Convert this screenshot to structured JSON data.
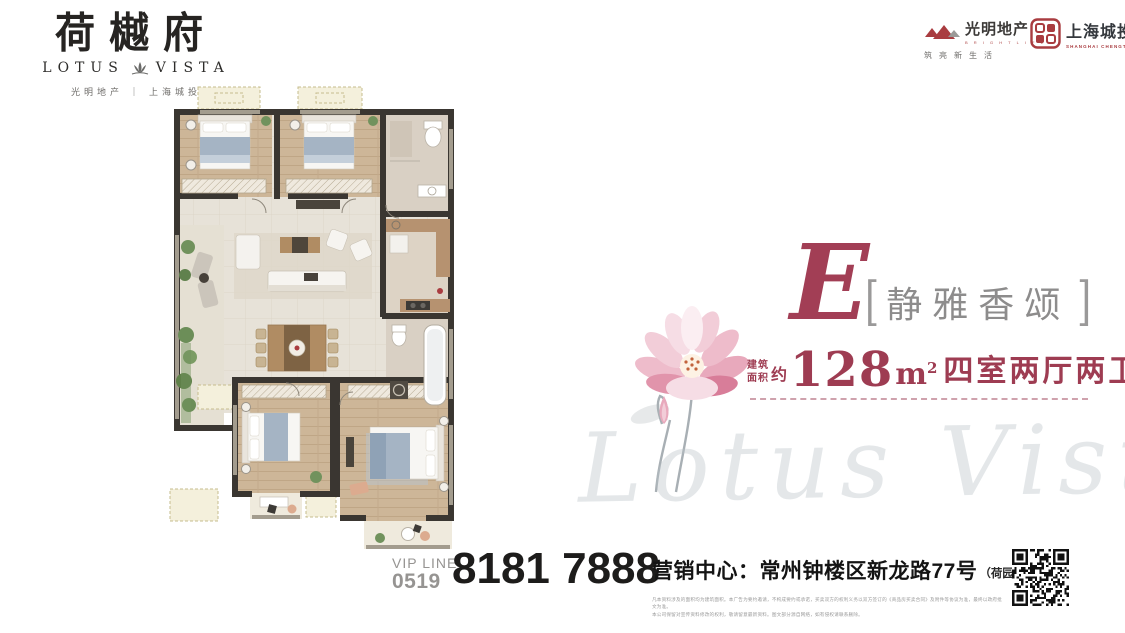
{
  "brand": {
    "name_cn": "荷樾府",
    "en_left": "LOTUS",
    "en_right": "VISTA",
    "developers": "光明地产 ｜ 上海城投"
  },
  "header_right": {
    "guangming": {
      "name": "光明地产",
      "tagline_en": "B R I G H T  L I F E",
      "slogan": "筑亮新生活"
    },
    "chengtou": {
      "name": "上海城投",
      "name_en": "SHANGHAI CHENGTOU"
    }
  },
  "unit": {
    "letter": "E",
    "bracket_left": "[",
    "bracket_right": "]",
    "title": "静雅香颂",
    "area_prefix_line1": "建筑",
    "area_prefix_line2": "面积",
    "area_approx": "约",
    "area_value": "128",
    "area_unit_base": "m",
    "area_unit_sup": "2",
    "layout": "四室两厅两卫"
  },
  "watermark": "Lotus Vista",
  "contact": {
    "vip_line_label": "VIP LINE",
    "area_code": "0519",
    "phone": "8181 7888",
    "sales_center": "营销中心：常州钟楼区新龙路77号",
    "sales_center_note": "（荷园正南侧）",
    "disclaimer_line1": "凡本资料涉及的面积均为建筑面积。本广告为要约邀请，不构成要约或承诺，买卖双方的权利义务以双方签订的《商品房买卖合同》及附件等协议为准，最终以政府批文为准。",
    "disclaimer_line2": "本公司保留对宣传资料修改的权利，敬请留意最新资料。图文部分源自网络，如有侵权请联系删除。"
  }
}
